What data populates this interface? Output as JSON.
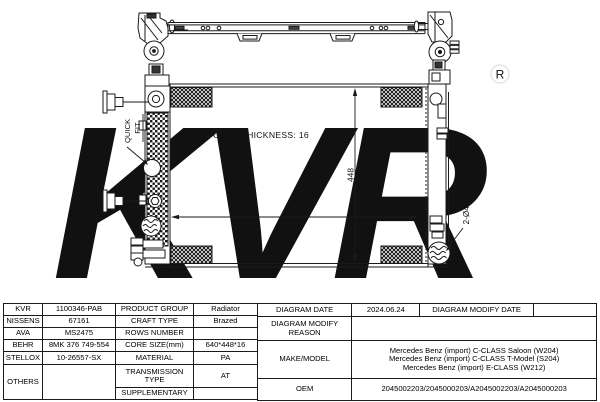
{
  "watermark": {
    "brand": "KVR",
    "registered_mark": "R"
  },
  "drawing": {
    "core_thickness_label": "CORE THICKNESS: 16",
    "core_width_mm": "640",
    "core_height_mm": "448",
    "port_diameter_label": "2-Ø46",
    "quick_fit_label_line1": "QUICK",
    "quick_fit_label_line2": "FIT"
  },
  "spec_table": {
    "brand_rows": [
      {
        "brand": "KVR",
        "number": "1100346-PAB",
        "attr": "PRODUCT GROUP",
        "value": "Radiator"
      },
      {
        "brand": "NISSENS",
        "number": "67161",
        "attr": "CRAFT TYPE",
        "value": "Brazed"
      },
      {
        "brand": "AVA",
        "number": "MS2475",
        "attr": "ROWS NUMBER",
        "value": ""
      },
      {
        "brand": "BEHR",
        "number": "8MK 376 749-554",
        "attr": "CORE SIZE(mm)",
        "value": "640*448*16"
      },
      {
        "brand": "STELLOX",
        "number": "10-26557-SX",
        "attr": "MATERIAL",
        "value": "PA"
      },
      {
        "brand": "OTHERS",
        "number": "",
        "attr": "TRANSMISSION TYPE",
        "value": "AT"
      },
      {
        "attr": "SUPPLEMENTARY",
        "value": ""
      }
    ],
    "info": {
      "diagram_date_label": "DIAGRAM DATE",
      "diagram_date": "2024.06.24",
      "diagram_modify_date_label": "DIAGRAM MODIFY DATE",
      "diagram_modify_date": "",
      "diagram_modify_reason_label": "DIAGRAM MODIFY REASON",
      "diagram_modify_reason": "",
      "make_model_label": "MAKE/MODEL",
      "make_model": [
        "Mercedes Benz (import) C-CLASS Saloon (W204)",
        "Mercedes Benz (import) C-CLASS T-Model (S204)",
        "Mercedes Benz (import) E-CLASS (W212)"
      ],
      "oem_label": "OEM",
      "oem": "2045002203/2045000203/A2045002203/A2045000203"
    }
  }
}
